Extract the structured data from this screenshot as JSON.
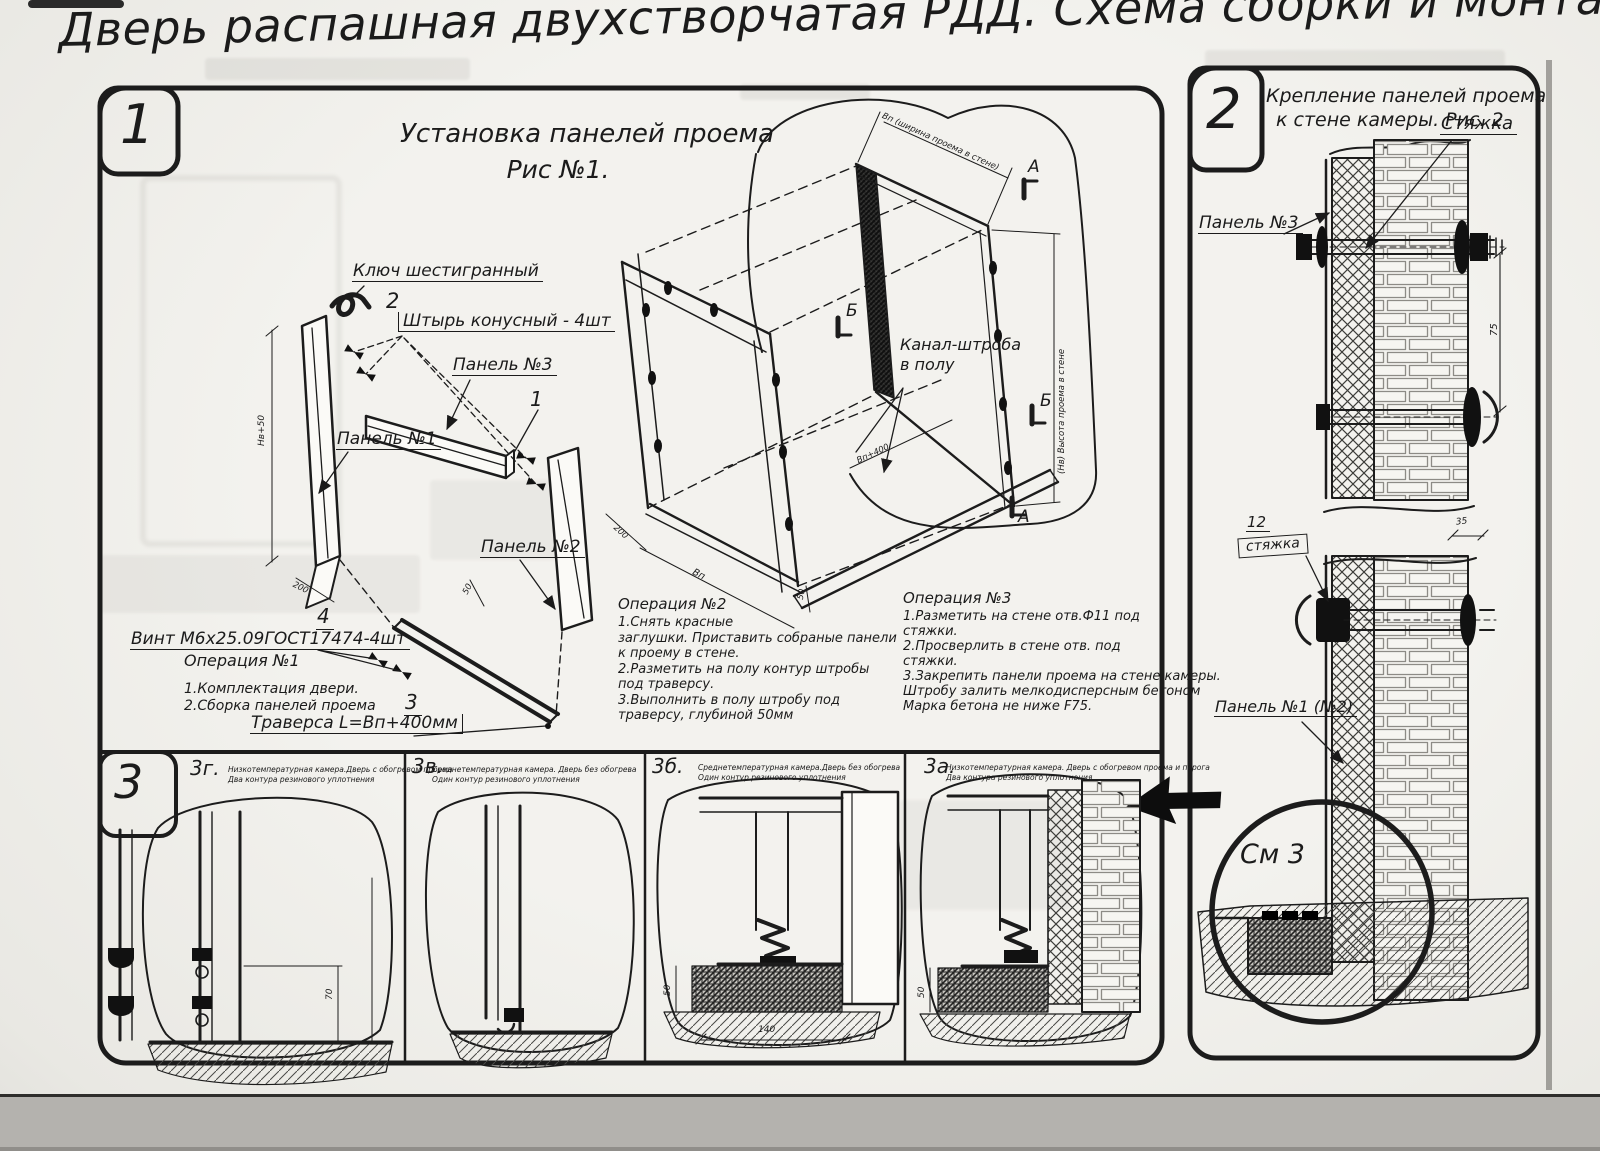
{
  "title": "Дверь распашная двухстворчатая РДД.  Схема сборки и монтажа №2",
  "fig1": {
    "tab": "1",
    "heading1": "Установка панелей проема",
    "heading2": "Рис №1.",
    "hex_key": "Ключ шестигранный",
    "pin_no": "2",
    "pin": "Штырь конусный - 4шт",
    "panel3": "Панель №3",
    "panel1": "Панель №1",
    "panel2": "Панель №2",
    "item1": "1",
    "screw_no": "4",
    "screw": "Винт М6х25.09ГОСТ17474-4шт",
    "traverse_no": "3",
    "traverse": "Траверса  L=Вп+400мм",
    "op1_title": "Операция №1",
    "op1_lines": [
      "1.Комплектация двери.",
      "2.Сборка панелей проема"
    ],
    "op2_title": "Операция №2",
    "op2_lines": [
      "1.Снять красные",
      "заглушки. Приставить собраные панели",
      "к проему в стене.",
      "2.Разметить на полу контур штробы",
      "под траверсу.",
      "3.Выполнить в полу штробу под",
      "траверсу, глубиной 50мм"
    ],
    "op3_title": "Операция №3",
    "op3_lines": [
      "1.Разметить на стене отв.Ф11 под",
      "стяжки.",
      "2.Просверлить в стене отв.   под",
      "стяжки.",
      "3.Закрепить панели проема на стене камеры.",
      "Штробу залить мелкодисперсным бетоном",
      "Марка бетона не ниже   F75."
    ],
    "channel1": "Канал-штроба",
    "channel2": "в полу",
    "marker_a": "А",
    "marker_b": "Б",
    "dim_top": "Вп (ширина проема в стене)",
    "dim_right": "(Hв) Высота проема в стене",
    "dims": {
      "hv50": "Hв+50",
      "d200": "200",
      "d50": "50",
      "bp": "Вп",
      "bp400": "Вп+400"
    }
  },
  "fig2": {
    "tab": "2",
    "heading1": "Крепление панелей проема",
    "heading2": "к стене камеры. Рис. 2",
    "tie": "Стяжка",
    "panel3": "Панель №3",
    "pos_no": "12",
    "pos": "стяжка",
    "panel12": "Панель №1 (№2)",
    "see": "См 3",
    "dim75": "75",
    "dim35": "35"
  },
  "sec3": {
    "tab": "3",
    "figs": [
      {
        "id": "3г.",
        "line1": "Низкотемпературная камера.Дверь с обогревом проема",
        "line2": "Два контура резинового уплотнения"
      },
      {
        "id": "3в.",
        "line1": "Среднетемпературная камера. Дверь без обогрева",
        "line2": "Один контур резинового уплотнения"
      },
      {
        "id": "3б.",
        "line1": "Среднетемпературная камера.Дверь без обогрева",
        "line2": "Один контур резинового уплотнения"
      },
      {
        "id": "3а.",
        "line1": "Низкотемпературная камера. Дверь с обогревом проема и порога",
        "line2": "Два контура резинового уплотнения"
      }
    ],
    "dim70": "70",
    "dim50": "50",
    "dim140": "140"
  }
}
